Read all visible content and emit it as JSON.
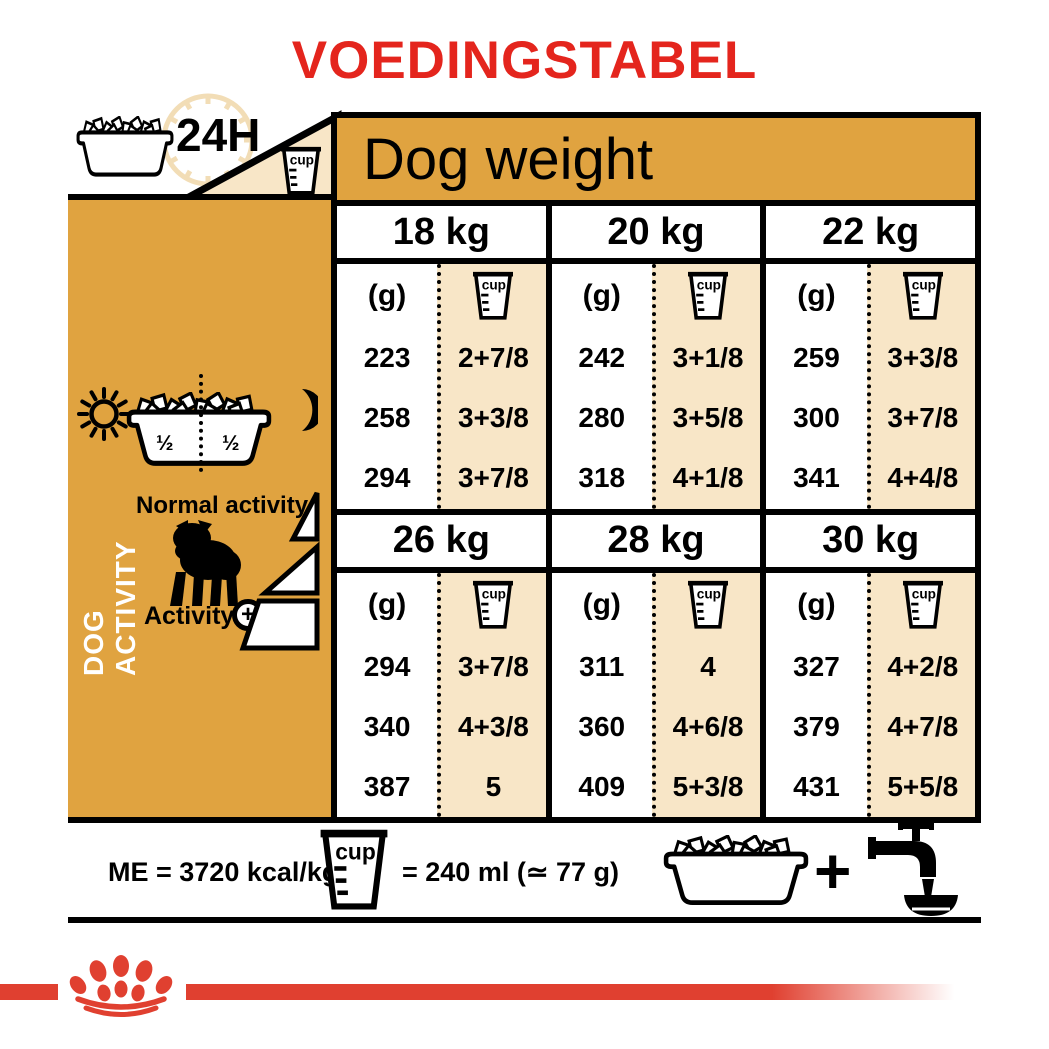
{
  "title": "VOEDINGSTABEL",
  "header": {
    "duration_label": "24H",
    "dog_weight_label": "Dog weight"
  },
  "activity_panel": {
    "vertical_label": "DOG ACTIVITY",
    "portion_left": "½",
    "portion_right": "½",
    "normal_activity_label": "Normal activity",
    "activity_label": "Activity",
    "activity_plus_symbol": "+"
  },
  "table": {
    "grams_header": "(g)",
    "cup_label": "cup",
    "blocks": [
      {
        "weight": "18 kg",
        "rows": [
          {
            "g": "223",
            "cups": "2+7/8"
          },
          {
            "g": "258",
            "cups": "3+3/8"
          },
          {
            "g": "294",
            "cups": "3+7/8"
          }
        ]
      },
      {
        "weight": "20 kg",
        "rows": [
          {
            "g": "242",
            "cups": "3+1/8"
          },
          {
            "g": "280",
            "cups": "3+5/8"
          },
          {
            "g": "318",
            "cups": "4+1/8"
          }
        ]
      },
      {
        "weight": "22 kg",
        "rows": [
          {
            "g": "259",
            "cups": "3+3/8"
          },
          {
            "g": "300",
            "cups": "3+7/8"
          },
          {
            "g": "341",
            "cups": "4+4/8"
          }
        ]
      },
      {
        "weight": "26 kg",
        "rows": [
          {
            "g": "294",
            "cups": "3+7/8"
          },
          {
            "g": "340",
            "cups": "4+3/8"
          },
          {
            "g": "387",
            "cups": "5"
          }
        ]
      },
      {
        "weight": "28 kg",
        "rows": [
          {
            "g": "311",
            "cups": "4"
          },
          {
            "g": "360",
            "cups": "4+6/8"
          },
          {
            "g": "409",
            "cups": "5+3/8"
          }
        ]
      },
      {
        "weight": "30 kg",
        "rows": [
          {
            "g": "327",
            "cups": "4+2/8"
          },
          {
            "g": "379",
            "cups": "4+7/8"
          },
          {
            "g": "431",
            "cups": "5+5/8"
          }
        ]
      }
    ]
  },
  "footer": {
    "me_label": "ME = 3720 kcal/kg",
    "cup_equiv_label": "= 240 ml (≃ 77 g)",
    "plus_symbol": "+"
  },
  "colors": {
    "accent_orange": "#E0A340",
    "cream": "#F8E6C7",
    "clock_tan": "#F2DDB6",
    "title_red": "#E4251D",
    "logo_red": "#E04030"
  }
}
